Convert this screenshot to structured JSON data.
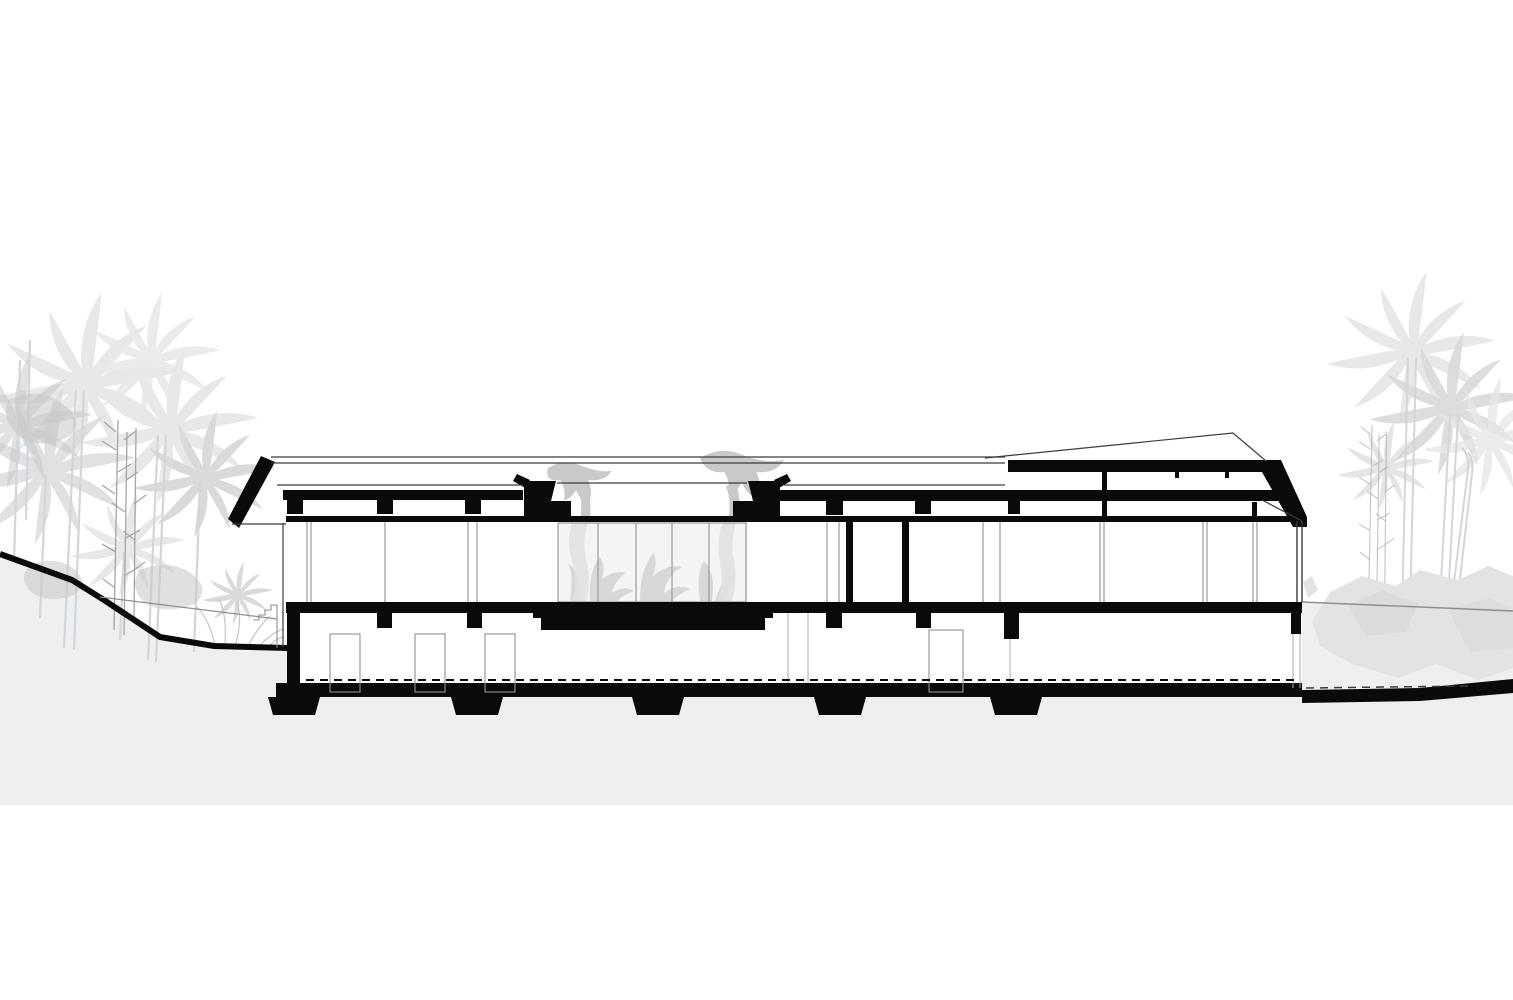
{
  "drawing": {
    "type": "architectural-section-drawing",
    "site": {
      "left": [
        "palm-trees",
        "bamboo",
        "shrubs",
        "sloping-terrain",
        "terrace-stairs"
      ],
      "right": [
        "palm-trees",
        "bamboo",
        "boulders",
        "flat-terrain"
      ]
    },
    "building": {
      "roof": [
        "cantilevered-left-eave",
        "roof-beam",
        "purlins",
        "skylight-with-hanging-vines",
        "raised-clerestory-roof",
        "right-eave-fascia"
      ],
      "main_floor": [
        "glass-walls",
        "cut-interior-walls",
        "planted-glass-atrium",
        "planter-pedestal"
      ],
      "lower_floor": [
        "doors",
        "partitions",
        "basement-wall"
      ],
      "foundation": [
        "floor-slab",
        "foundation-slab",
        "footing-pads",
        "damp-proof-dashed-line"
      ]
    }
  },
  "colors": {
    "ink": "#0a0a0a",
    "line_dark": "#3c3c3c",
    "line_mid": "#8f8f8f",
    "line_light": "#ababab",
    "ground": "#efefef",
    "veg_light": "#e8e8e8",
    "veg_mid": "#dadada",
    "veg_dark": "#c6c6c6",
    "trunk": "#d2d6da",
    "bamboo": "#a6a6a6",
    "boulder": "#e3e3e3",
    "boulder_dark": "#d7d7d7",
    "glass": "#ececec",
    "glass_line": "#9a9a9a",
    "vine": "#c9c9c9",
    "plant": "#b9b9b9",
    "white": "#ffffff"
  }
}
